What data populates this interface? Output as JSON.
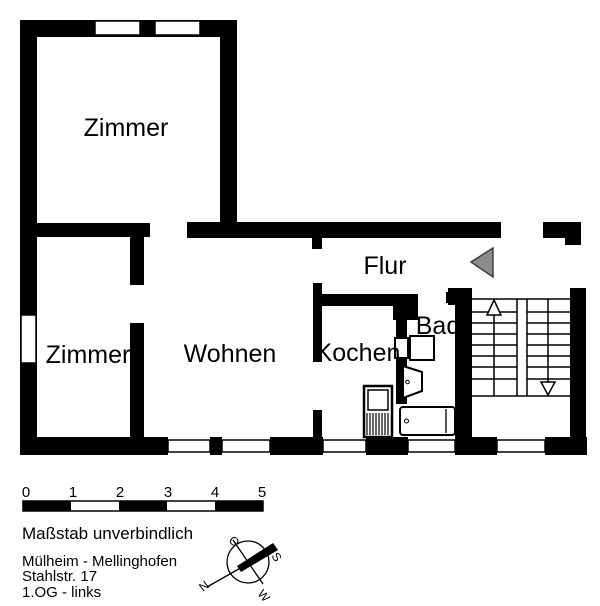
{
  "plan": {
    "title": "floor-plan",
    "rooms": {
      "zimmer_top": "Zimmer",
      "zimmer_bottom": "Zimmer",
      "wohnen": "Wohnen",
      "kochen": "Kochen",
      "bad": "Bad",
      "flur": "Flur"
    }
  },
  "scale_bar": {
    "labels": [
      "0",
      "1",
      "2",
      "3",
      "4",
      "5"
    ],
    "note": "Maßstab unverbindlich"
  },
  "footer": {
    "line1": "Mülheim - Mellinghofen",
    "line2": "Stahlstr. 17",
    "line3": "1.OG - links"
  },
  "compass": {
    "north": "N",
    "east": "O",
    "south": "S",
    "west": "W"
  },
  "colors": {
    "wall": "#000000",
    "door_arrow": "#8c8c8c",
    "background": "#ffffff"
  }
}
